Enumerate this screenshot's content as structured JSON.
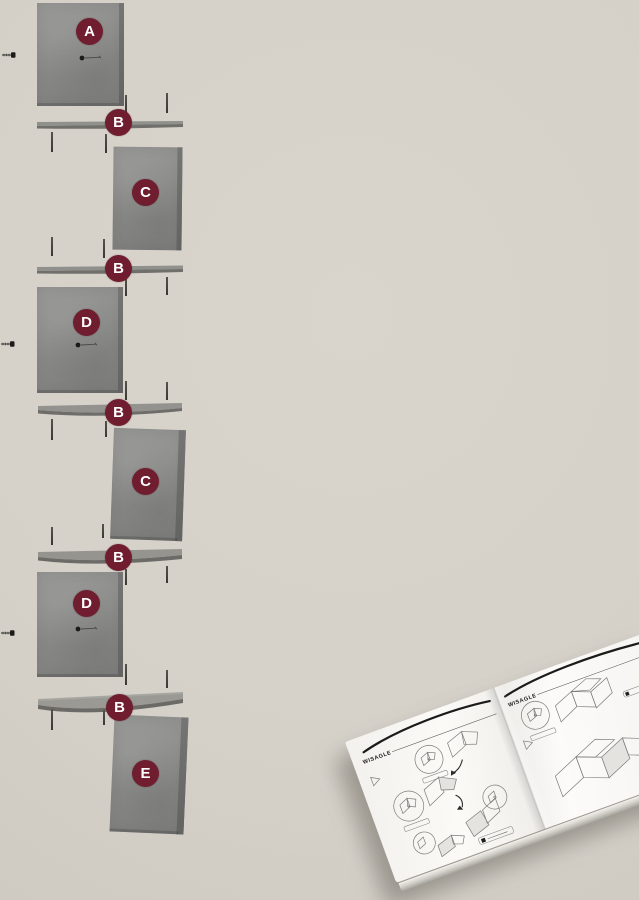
{
  "canvas": {
    "width": 639,
    "height": 900
  },
  "colors": {
    "background": "#d5d1c9",
    "panel": "#8b8b89",
    "panel_edge": "#6a6a68",
    "badge": "#6f1d2f",
    "badge_text": "#ffffff",
    "pin": "#45423c",
    "page": "#f8f7f4"
  },
  "diagram": {
    "description": "Exploded assembly view of a corner wall shelf unit with labeled parts",
    "parts": [
      {
        "id": "panel-a",
        "label": "A"
      },
      {
        "id": "shelf-b-1",
        "label": "B"
      },
      {
        "id": "panel-c-1",
        "label": "C"
      },
      {
        "id": "shelf-b-2",
        "label": "B"
      },
      {
        "id": "panel-d-1",
        "label": "D"
      },
      {
        "id": "shelf-b-3",
        "label": "B"
      },
      {
        "id": "panel-c-2",
        "label": "C"
      },
      {
        "id": "shelf-b-4",
        "label": "B"
      },
      {
        "id": "panel-d-2",
        "label": "D"
      },
      {
        "id": "shelf-b-5",
        "label": "B"
      },
      {
        "id": "panel-e",
        "label": "E"
      }
    ]
  },
  "booklet": {
    "brand": "WISAGLE"
  }
}
